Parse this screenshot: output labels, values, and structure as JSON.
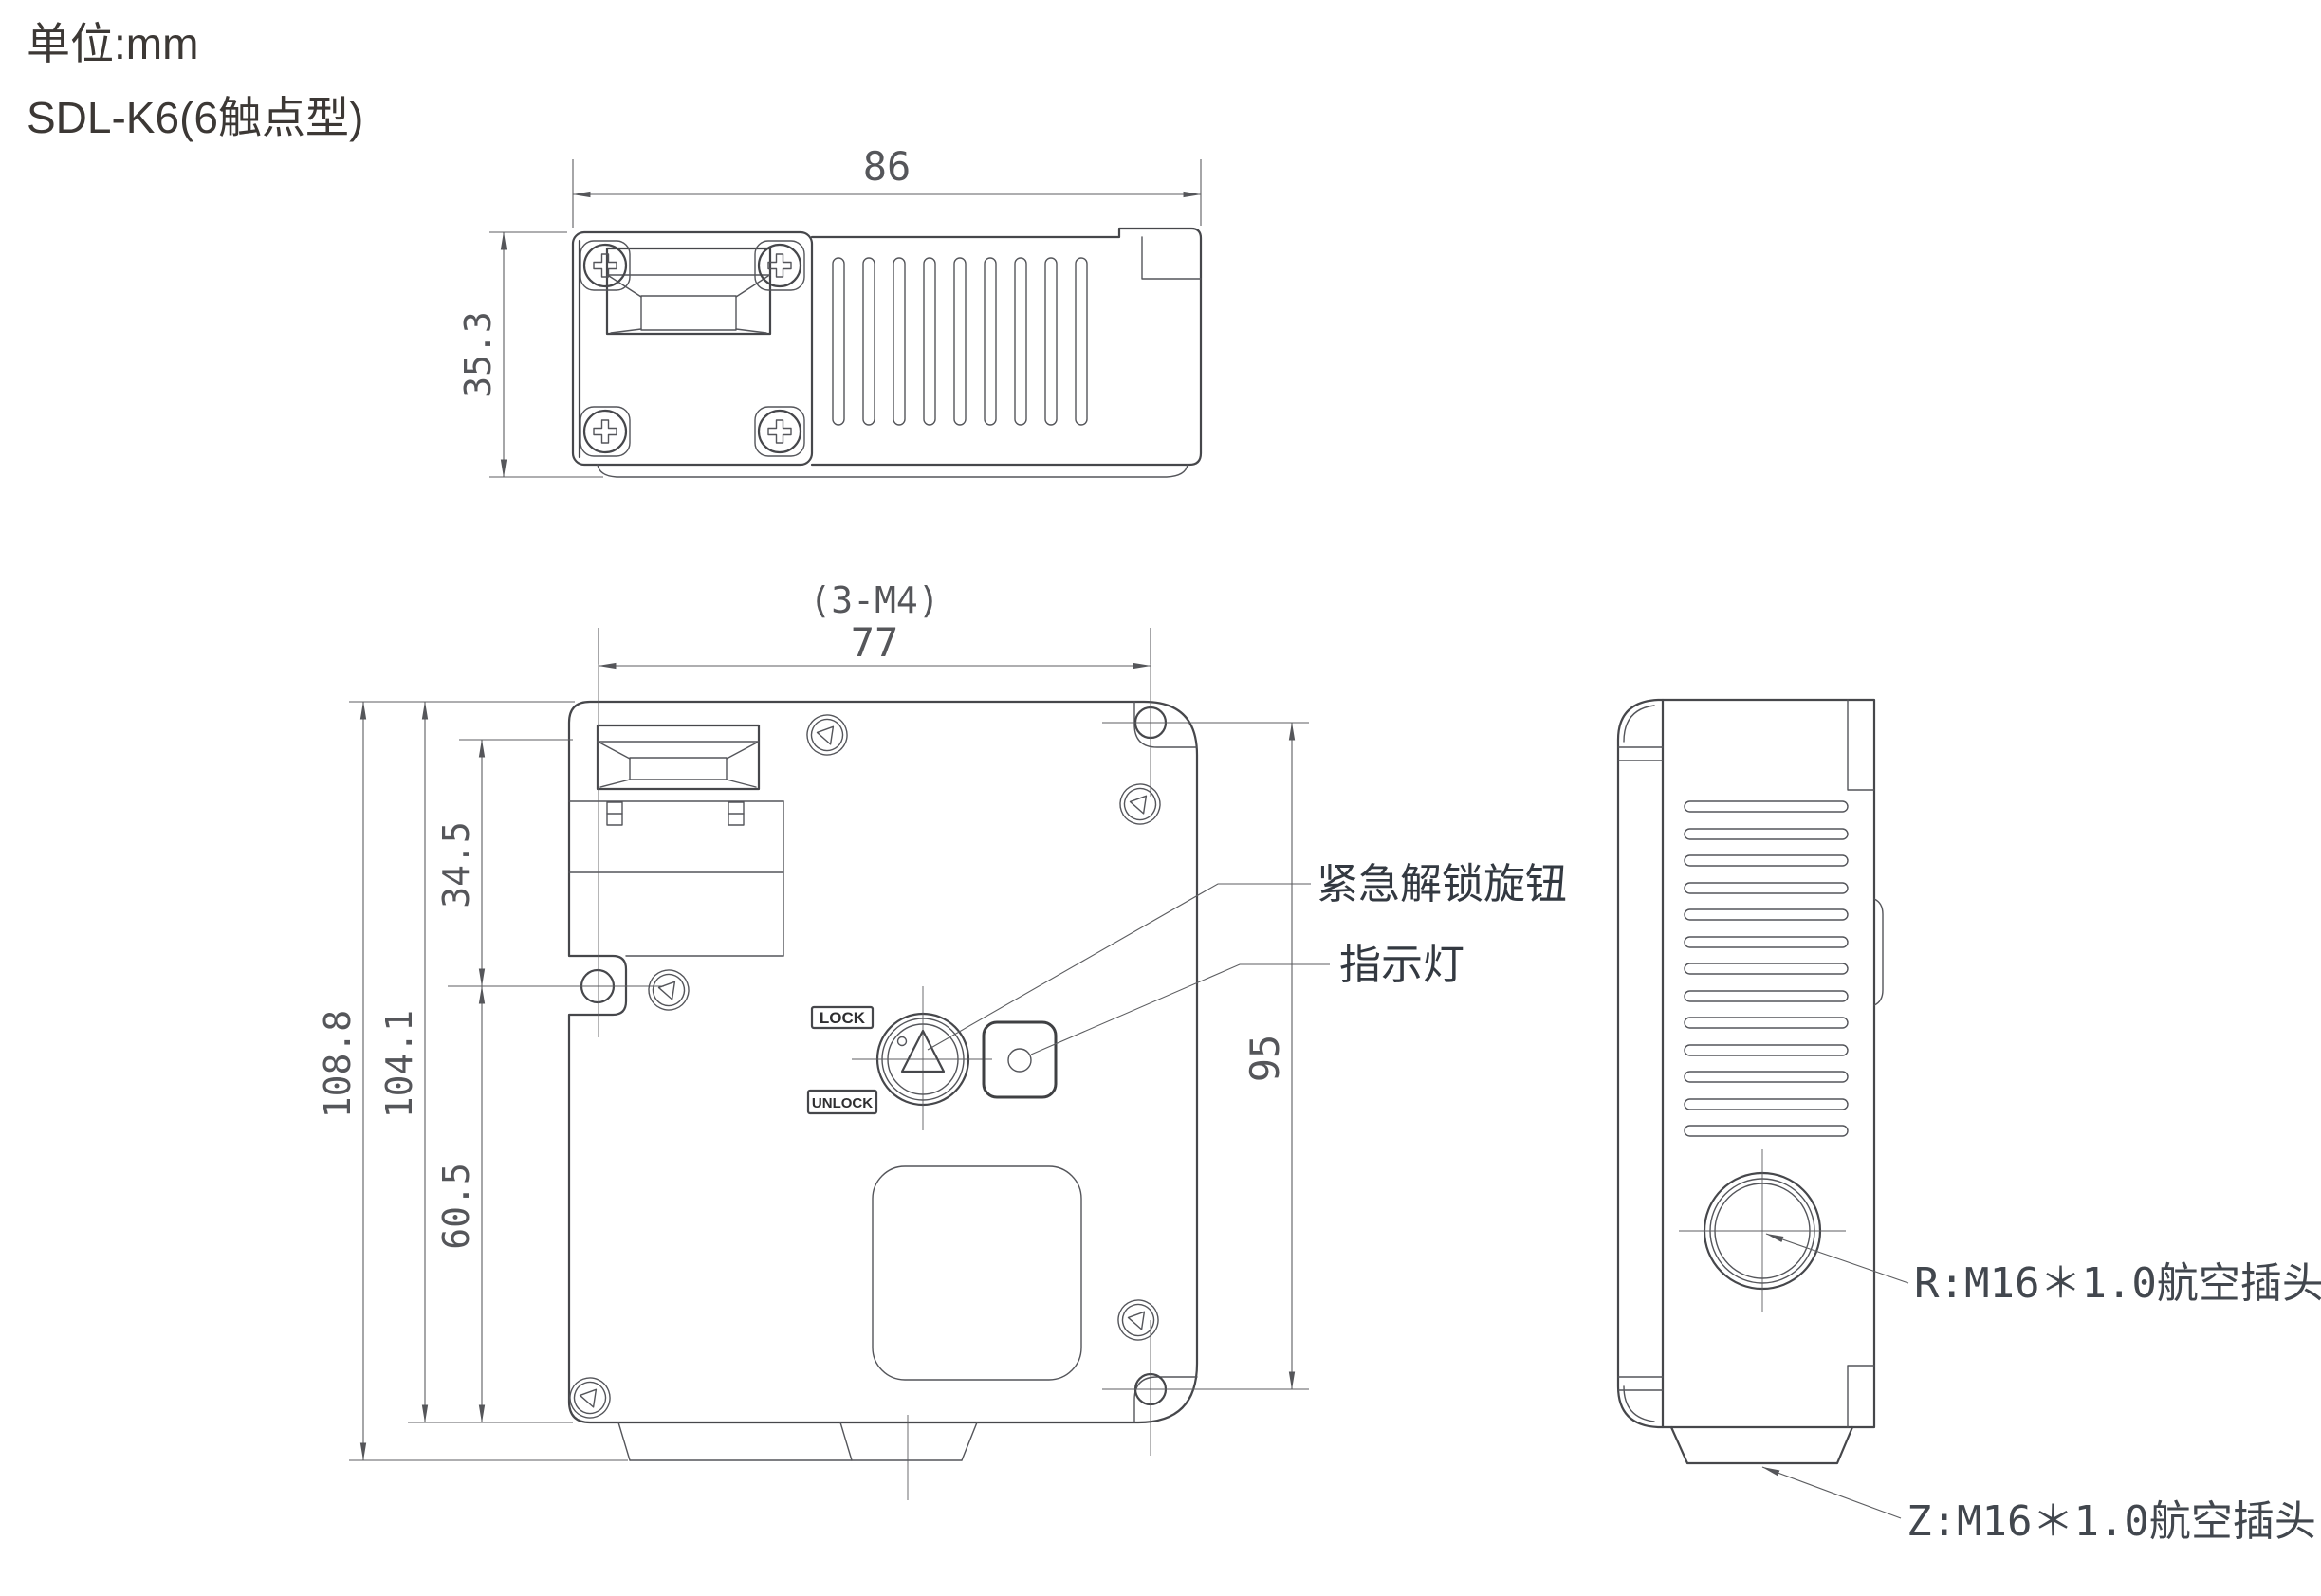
{
  "title": {
    "unit": "单位:mm",
    "model": "SDL-K6(6触点型)"
  },
  "colors": {
    "background": "#ffffff",
    "outline": "#46474b",
    "dimension_line": "#5c5d60",
    "dimension_text": "#55565a",
    "callout_text": "#333941",
    "title_text": "#3c3835"
  },
  "top_view": {
    "dim_width": "86",
    "dim_height": "35.3"
  },
  "front_view": {
    "dim_hole_pattern": "(3-M4)",
    "dim_hole_span": "77",
    "dim_plate_to_hole": "34.5",
    "dim_body_height": "104.1",
    "dim_total_height": "108.8",
    "dim_hole_to_bottom": "60.5",
    "dim_right_hole_span": "95",
    "lock_label": "LOCK",
    "unlock_label": "UNLOCK"
  },
  "callouts": {
    "emergency_knob": "紧急解锁旋钮",
    "indicator_light": "指示灯",
    "r_connector": "R:M16＊1.0航空插头",
    "z_connector": "Z:M16＊1.0航空插头"
  }
}
